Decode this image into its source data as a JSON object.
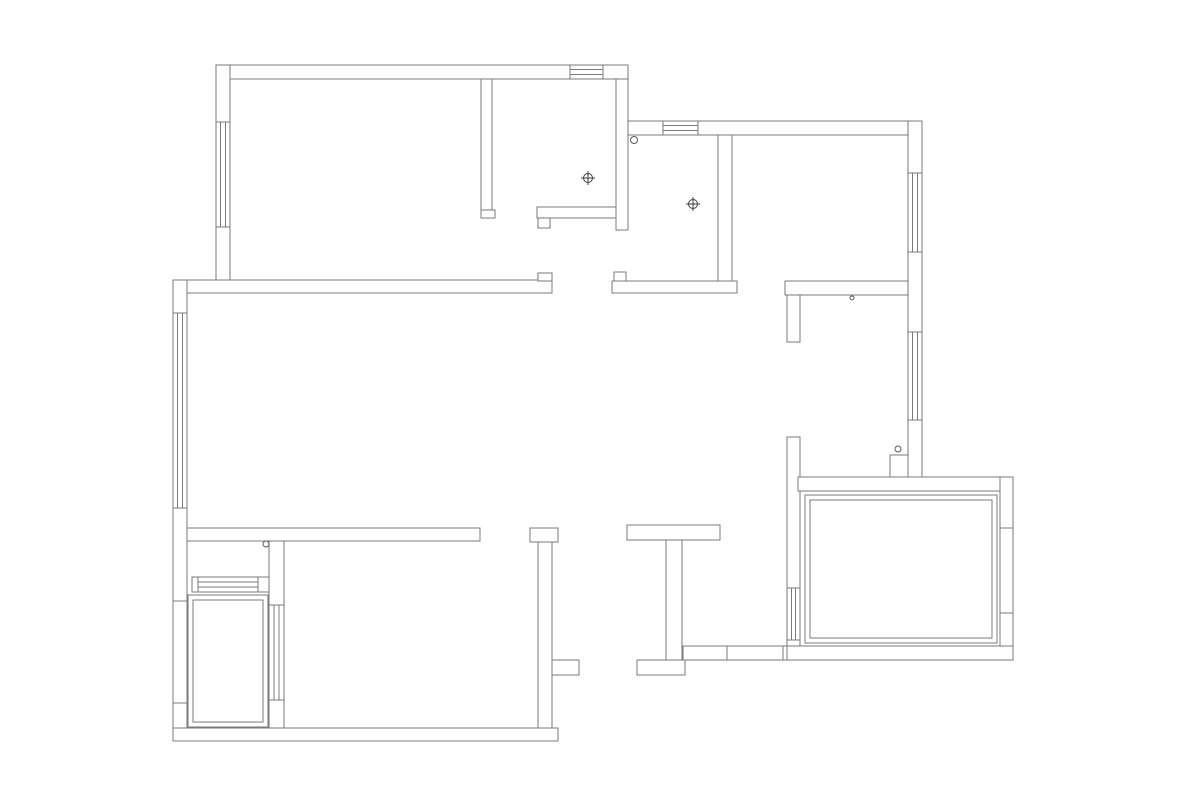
{
  "meta": {
    "canvas": {
      "width": 1200,
      "height": 806
    },
    "colors": {
      "background": "#ffffff",
      "wall_line": "#7a7a7a",
      "symbol_line": "#3c3c3c",
      "hinge_line": "#5a5a5a"
    }
  },
  "floor_plan": {
    "walls": [
      {
        "name": "bedroom1-top-wall",
        "x": 216,
        "y": 65,
        "w": 412,
        "h": 14
      },
      {
        "name": "bedroom1-left-wall",
        "x": 216,
        "y": 65,
        "w": 14,
        "h": 217
      },
      {
        "name": "bedroom1-closet-wall",
        "x": 481,
        "y": 79,
        "w": 11,
        "h": 131
      },
      {
        "name": "bedroom1-closet-wall-foot",
        "x": 481,
        "y": 210,
        "w": 14,
        "h": 8
      },
      {
        "name": "closet-bottom-wall",
        "x": 537,
        "y": 207,
        "w": 79,
        "h": 11
      },
      {
        "name": "closet-bottom-notch",
        "x": 538,
        "y": 218,
        "w": 12,
        "h": 10
      },
      {
        "name": "closet-right-wall",
        "x": 616,
        "y": 79,
        "w": 12,
        "h": 151
      },
      {
        "name": "entry-top-wall",
        "x": 628,
        "y": 121,
        "w": 294,
        "h": 14
      },
      {
        "name": "right-outer-wall",
        "x": 908,
        "y": 121,
        "w": 14,
        "h": 356
      },
      {
        "name": "entry-right-wall",
        "x": 718,
        "y": 135,
        "w": 14,
        "h": 146
      },
      {
        "name": "entry-bottom-wall",
        "x": 612,
        "y": 281,
        "w": 125,
        "h": 12
      },
      {
        "name": "entry-bottom-jamb",
        "x": 614,
        "y": 272,
        "w": 12,
        "h": 9
      },
      {
        "name": "living-top-wall",
        "x": 173,
        "y": 280,
        "w": 379,
        "h": 13
      },
      {
        "name": "living-top-wall-cap",
        "x": 538,
        "y": 273,
        "w": 14,
        "h": 8
      },
      {
        "name": "left-outer-wall",
        "x": 173,
        "y": 280,
        "w": 14,
        "h": 461
      },
      {
        "name": "living-bottom-wall",
        "x": 187,
        "y": 528,
        "w": 293,
        "h": 13
      },
      {
        "name": "laundry-partition-wall",
        "x": 269,
        "y": 541,
        "w": 15,
        "h": 196
      },
      {
        "name": "laundry-window-wall",
        "x": 192,
        "y": 577,
        "w": 77,
        "h": 15
      },
      {
        "name": "t-wall-cap",
        "x": 530,
        "y": 528,
        "w": 28,
        "h": 14
      },
      {
        "name": "t-wall-stem",
        "x": 538,
        "y": 542,
        "w": 14,
        "h": 199
      },
      {
        "name": "t-wall-foot",
        "x": 552,
        "y": 660,
        "w": 27,
        "h": 15
      },
      {
        "name": "bottom-outer-wall",
        "x": 173,
        "y": 728,
        "w": 385,
        "h": 13
      },
      {
        "name": "i-wall-top-bar",
        "x": 627,
        "y": 525,
        "w": 93,
        "h": 15
      },
      {
        "name": "i-wall-stem",
        "x": 666,
        "y": 540,
        "w": 16,
        "h": 120
      },
      {
        "name": "i-wall-foot-bar",
        "x": 637,
        "y": 660,
        "w": 48,
        "h": 15
      },
      {
        "name": "corridor-south-wall",
        "x": 683,
        "y": 646,
        "w": 107,
        "h": 14
      },
      {
        "name": "kitchen-bottom-wall",
        "x": 785,
        "y": 281,
        "w": 123,
        "h": 14
      },
      {
        "name": "kitchen-bottom-wall-leg",
        "x": 787,
        "y": 295,
        "w": 13,
        "h": 47
      },
      {
        "name": "master-left-wall",
        "x": 787,
        "y": 437,
        "w": 13,
        "h": 223
      },
      {
        "name": "master-top-wall",
        "x": 798,
        "y": 477,
        "w": 215,
        "h": 14
      },
      {
        "name": "master-right-wall",
        "x": 1000,
        "y": 477,
        "w": 13,
        "h": 183
      },
      {
        "name": "master-bottom-wall",
        "x": 787,
        "y": 646,
        "w": 226,
        "h": 14
      },
      {
        "name": "column",
        "x": 890,
        "y": 455,
        "w": 18,
        "h": 22
      }
    ],
    "windows": [
      {
        "name": "bedroom1-top-window",
        "x": 570,
        "y": 65,
        "w": 33,
        "h": 14,
        "dir": "h"
      },
      {
        "name": "bedroom1-left-window",
        "x": 216,
        "y": 122,
        "w": 14,
        "h": 105,
        "dir": "v"
      },
      {
        "name": "entry-top-window",
        "x": 663,
        "y": 121,
        "w": 35,
        "h": 14,
        "dir": "h"
      },
      {
        "name": "right-wall-window-upper",
        "x": 908,
        "y": 173,
        "w": 14,
        "h": 79,
        "dir": "v"
      },
      {
        "name": "right-wall-window-lower",
        "x": 908,
        "y": 332,
        "w": 14,
        "h": 88,
        "dir": "v"
      },
      {
        "name": "living-left-window",
        "x": 173,
        "y": 313,
        "w": 14,
        "h": 195,
        "dir": "v"
      },
      {
        "name": "laundry-partition-window",
        "x": 269,
        "y": 605,
        "w": 15,
        "h": 95,
        "dir": "v"
      },
      {
        "name": "laundry-window",
        "x": 198,
        "y": 577,
        "w": 60,
        "h": 15,
        "dir": "h"
      },
      {
        "name": "master-left-window",
        "x": 787,
        "y": 588,
        "w": 13,
        "h": 52,
        "dir": "v"
      }
    ],
    "inner_rects": [
      {
        "name": "master-inner-rect-outer",
        "x": 805,
        "y": 495,
        "w": 192,
        "h": 148
      },
      {
        "name": "master-inner-rect-inner",
        "x": 810,
        "y": 500,
        "w": 182,
        "h": 138
      },
      {
        "name": "laundry-platform-outer",
        "x": 188,
        "y": 595,
        "w": 80,
        "h": 132
      },
      {
        "name": "laundry-platform-inner",
        "x": 193,
        "y": 600,
        "w": 70,
        "h": 122
      }
    ],
    "ticks": [
      {
        "name": "left-wall-tick-upper",
        "x1": 173,
        "y1": 601,
        "x2": 187,
        "y2": 601
      },
      {
        "name": "left-wall-tick-lower",
        "x1": 173,
        "y1": 703,
        "x2": 187,
        "y2": 703
      },
      {
        "name": "master-right-tick-upper",
        "x1": 1000,
        "y1": 528,
        "x2": 1013,
        "y2": 528
      },
      {
        "name": "master-right-tick-lower",
        "x1": 1000,
        "y1": 613,
        "x2": 1013,
        "y2": 613
      },
      {
        "name": "corridor-wall-tick-left",
        "x1": 727,
        "y1": 646,
        "x2": 727,
        "y2": 660
      },
      {
        "name": "corridor-wall-tick-right",
        "x1": 783,
        "y1": 646,
        "x2": 783,
        "y2": 660
      }
    ],
    "hinge_circles": [
      {
        "name": "entry-door-hinge",
        "cx": 634,
        "cy": 140,
        "r": 3.5
      },
      {
        "name": "laundry-door-hinge",
        "cx": 266,
        "cy": 544,
        "r": 3
      },
      {
        "name": "kitchen-wall-dot",
        "cx": 852,
        "cy": 298,
        "r": 2
      },
      {
        "name": "column-dot",
        "cx": 898,
        "cy": 449,
        "r": 3
      }
    ],
    "survey_targets": [
      {
        "name": "survey-target-closet",
        "cx": 588,
        "cy": 178,
        "r": 4.5,
        "arm": 7
      },
      {
        "name": "survey-target-entry",
        "cx": 693,
        "cy": 204,
        "r": 4.5,
        "arm": 7
      }
    ]
  }
}
